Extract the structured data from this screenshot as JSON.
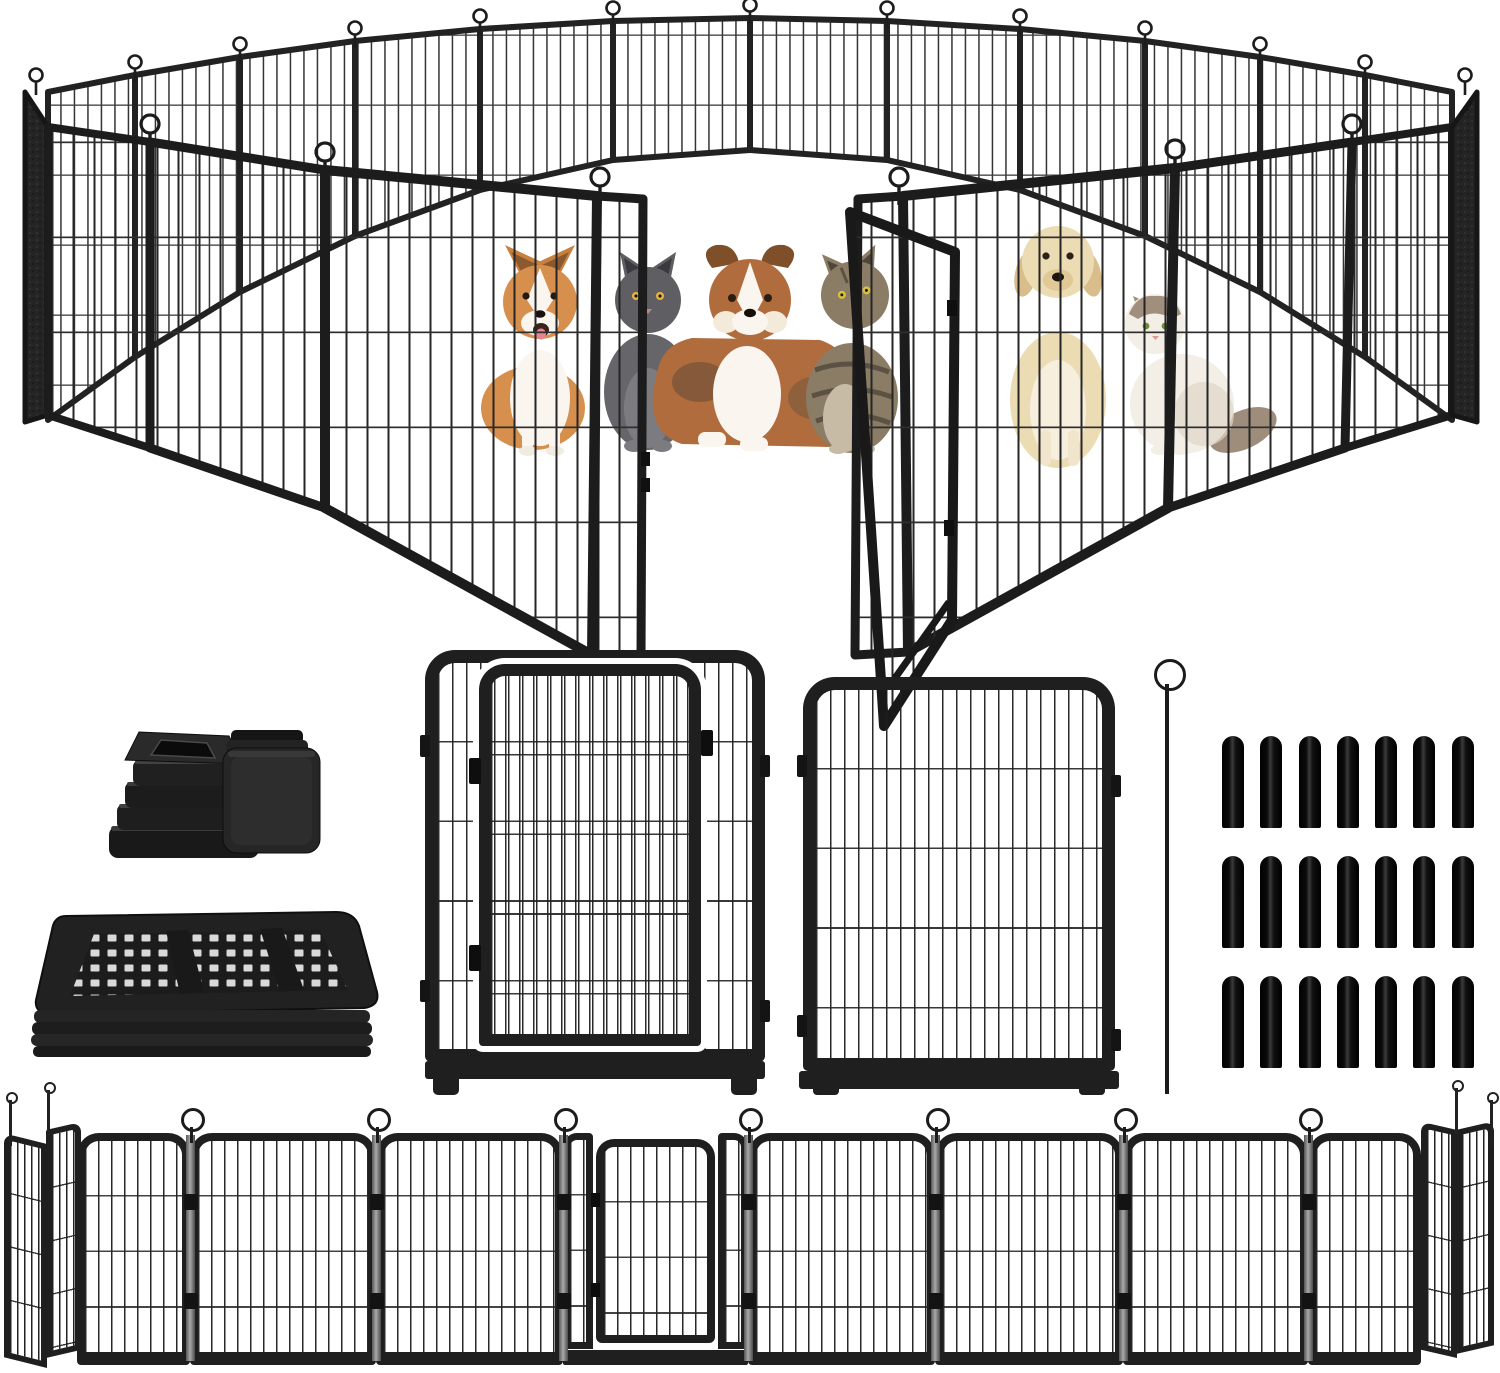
{
  "page": {
    "type": "product-image",
    "background": "#ffffff",
    "visible_text": ""
  },
  "theme": {
    "colors": {
      "frame": "#1f1f1f",
      "frame-dark": "#121212",
      "wire": "#2c2c2c",
      "metal-gray": "#9a9a9a",
      "slab": "#242424",
      "cap-black": "#0a0a0a",
      "white": "#ffffff"
    }
  },
  "hero_scene": {
    "name": "metal-playpen-ring-with-pets",
    "visible_panel_count": 20,
    "gate": {
      "state": "open",
      "position": "front-center"
    },
    "loop_pin_count": 19,
    "pets": [
      {
        "type": "corgi-dog",
        "colors": [
          "#d78f4e",
          "#faf6ef"
        ]
      },
      {
        "type": "gray-cat",
        "colors": [
          "#5e5e63"
        ]
      },
      {
        "type": "australian-shepherd-dog",
        "colors": [
          "#b06c3c",
          "#faf6ef",
          "#7e4f28"
        ]
      },
      {
        "type": "tabby-cat",
        "colors": [
          "#8b7c66",
          "#5c5243"
        ]
      },
      {
        "type": "cream-dog",
        "colors": [
          "#ecdcb4"
        ]
      },
      {
        "type": "fluffy-white-cat",
        "colors": [
          "#f3efe7",
          "#a08f7d"
        ]
      }
    ]
  },
  "accessories": {
    "tube_caps": {
      "count": 2,
      "styles": [
        "ribbed-insert-plug",
        "smooth-square-cap"
      ],
      "color": "#1e1e1e"
    },
    "folded_stack": {
      "stacked_panel_count": 5,
      "color": "#212121"
    },
    "door_panel": {
      "type": "panel-with-arched-door",
      "hinge_count": 2,
      "latch_count": 1
    },
    "fence_panel": {
      "type": "standard-panel",
      "vertical_bar_count": 20,
      "horizontal_wire_count": 4
    },
    "ground_stake": {
      "count": 1,
      "loop_top": true
    },
    "spike_caps": {
      "count": 21,
      "rows": 3,
      "per_row": 7,
      "color": "#0a0a0a"
    }
  },
  "bottom_row": {
    "flat_panel_count": 7,
    "gate_panel": {
      "position": "center",
      "state": "closed"
    },
    "junction_pin_count": 7,
    "folded_end_panels": {
      "left": 2,
      "right": 2
    }
  }
}
